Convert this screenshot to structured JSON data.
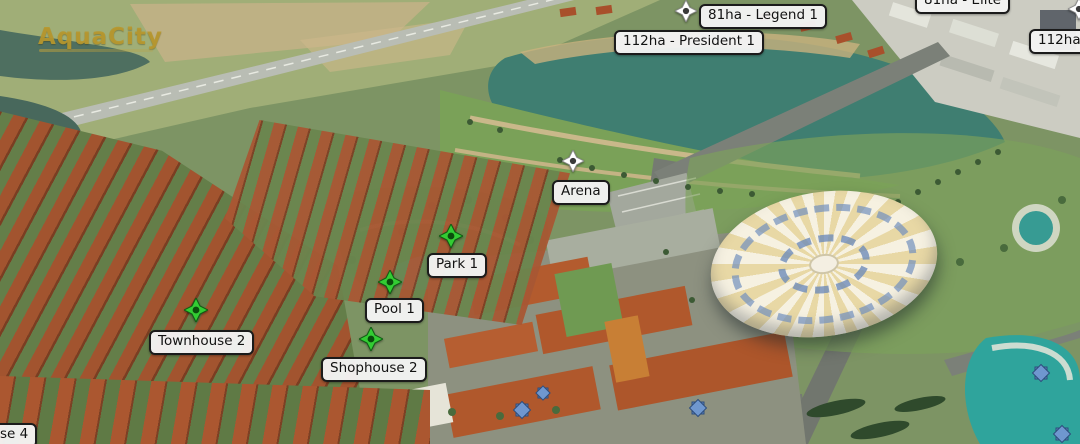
{
  "app": {
    "name": "AquaCity masterplan map viewer"
  },
  "logo": {
    "title": "AquaCity"
  },
  "map": {
    "area_labels": [
      {
        "id": "elite",
        "text": "81ha - Elite"
      },
      {
        "id": "legend-1",
        "text": "81ha - Legend 1"
      },
      {
        "id": "president-1",
        "text": "112ha - President 1"
      },
      {
        "id": "112ha",
        "text": "112ha"
      },
      {
        "id": "arena",
        "text": "Arena"
      },
      {
        "id": "park-1",
        "text": "Park 1"
      },
      {
        "id": "pool-1",
        "text": "Pool 1"
      },
      {
        "id": "townhouse-2",
        "text": "Townhouse 2"
      },
      {
        "id": "shophouse-2",
        "text": "Shophouse 2"
      },
      {
        "id": "house-4",
        "text": "se 4"
      }
    ],
    "markers": [
      {
        "icon": "target-diamond-icon",
        "color": "#ffffff",
        "label": "81ha - Legend 1"
      },
      {
        "icon": "target-diamond-icon",
        "color": "#ffffff",
        "label": "Arena"
      },
      {
        "icon": "target-diamond-icon",
        "color": "#ffffff",
        "label": "112ha"
      },
      {
        "icon": "target-diamond-icon",
        "color": "#33cc33",
        "label": "Park 1"
      },
      {
        "icon": "target-diamond-icon",
        "color": "#33cc33",
        "label": "Pool 1"
      },
      {
        "icon": "target-diamond-icon",
        "color": "#33cc33",
        "label": "Townhouse 2"
      },
      {
        "icon": "target-diamond-icon",
        "color": "#33cc33",
        "label": "Shophouse 2"
      }
    ]
  },
  "colors": {
    "label_background": "#f3f3f3",
    "label_border": "#1b1b1b",
    "label_text": "#121212",
    "marker_green": "#33cc33",
    "marker_white": "#ffffff",
    "logo_gold": "#b9982e",
    "lake_teal": "#3f7e71",
    "roof_terracotta": "#a85733",
    "dome_cream": "#e8d8a5",
    "dome_blue": "#7d9cc4"
  }
}
